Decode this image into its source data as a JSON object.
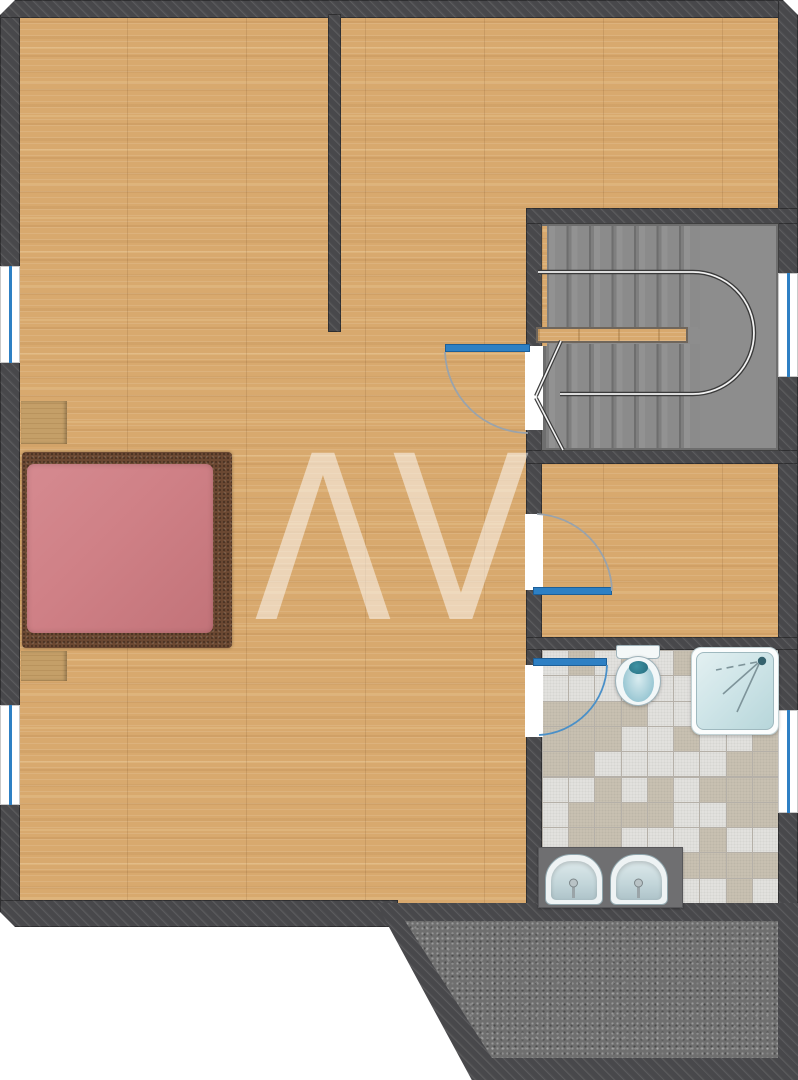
{
  "meta": {
    "title": "Upper floor plan",
    "plan_width_px": 798,
    "plan_height_px": 1080
  },
  "watermark": {
    "text": "AV",
    "glyphs": "ΛV",
    "opacity": 0.5
  },
  "palette": {
    "page_bg": "#ffffff",
    "wall": "#48484b",
    "wood": "#d8a96e",
    "stair_floor": "#8d8d8d",
    "terrace_floor": "#6f6f6f",
    "tile_light": "#e3e2df",
    "tile_beige": "#c9c1b2",
    "grout": "#b5b0a8",
    "door_blue": "#2e80c4",
    "window_blue": "#2e80c4",
    "arc_gray": "#9aa3ab",
    "arc_blue": "#4a90c8",
    "bed_pink": "#cf8086",
    "bed_frame": "#6b4832",
    "nightstand_wood": "#c49f68",
    "counter_gray": "#6f6f71",
    "rail_dark": "#3a3a3a",
    "rail_light": "#f2f2f2"
  },
  "rooms": [
    {
      "id": "main-room",
      "floor": "parquet"
    },
    {
      "id": "top-left-room",
      "floor": "parquet"
    },
    {
      "id": "top-right-room",
      "floor": "parquet"
    },
    {
      "id": "stair-hall",
      "floor": "concrete-gray"
    },
    {
      "id": "small-room",
      "floor": "parquet"
    },
    {
      "id": "bathroom",
      "floor": "checker-tiles"
    },
    {
      "id": "terrace",
      "floor": "speckled-stone"
    }
  ],
  "fixtures": [
    {
      "id": "bed",
      "type": "double-bed-pink"
    },
    {
      "id": "nightstand-top",
      "type": "nightstand"
    },
    {
      "id": "nightstand-bottom",
      "type": "nightstand"
    },
    {
      "id": "staircase",
      "type": "u-shaped-stair-with-railing"
    },
    {
      "id": "toilet",
      "type": "toilet"
    },
    {
      "id": "shower",
      "type": "shower-tray"
    },
    {
      "id": "vanity",
      "type": "double-sink-counter"
    },
    {
      "id": "window-left-upper",
      "type": "window"
    },
    {
      "id": "window-left-lower",
      "type": "window"
    },
    {
      "id": "window-right-stair",
      "type": "window"
    },
    {
      "id": "window-right-bath",
      "type": "window"
    },
    {
      "id": "door-stair-hall",
      "type": "hinged-door"
    },
    {
      "id": "door-small-room",
      "type": "hinged-door"
    },
    {
      "id": "door-bathroom",
      "type": "hinged-door"
    }
  ]
}
